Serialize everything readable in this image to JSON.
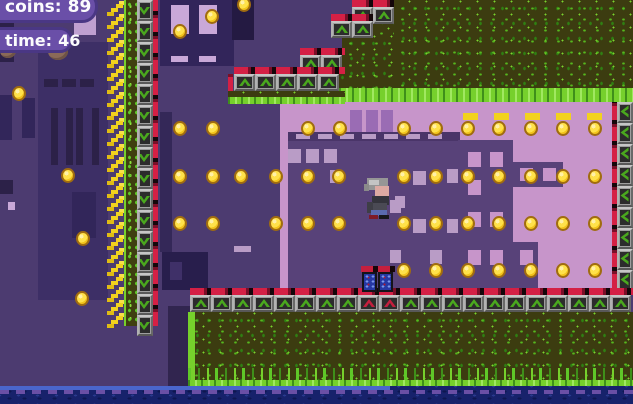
{
  "hud": {
    "coins": {
      "label": "coins:",
      "value": "89"
    },
    "time": {
      "label": "time:",
      "value": "46"
    }
  },
  "palette": {
    "hud_badge": "#6a4fa8",
    "coin_gold": "#f2c41c",
    "brick_red": "#c41f3e",
    "grass_bright": "#76d02c",
    "grass_dark": "#3c3c10",
    "water_navy": "#17226b",
    "bg_purple": "#4c3b70",
    "pink_building": "#c795ca"
  },
  "player": {
    "x": 366,
    "y": 178
  },
  "door": {
    "x": 361,
    "y": 266,
    "type": "blue-door"
  },
  "coins": {
    "singles": [
      [
        19,
        93
      ],
      [
        68,
        175
      ],
      [
        83,
        238
      ],
      [
        82,
        298
      ],
      [
        180,
        31
      ],
      [
        212,
        16
      ],
      [
        244,
        4
      ]
    ],
    "rows": [
      {
        "y": 128,
        "xs": [
          180,
          213,
          308,
          340,
          404,
          436,
          468,
          499,
          531,
          563,
          595
        ]
      },
      {
        "y": 176,
        "xs": [
          180,
          213,
          241,
          276,
          308,
          339,
          404,
          436,
          468,
          499,
          531,
          563,
          595
        ]
      },
      {
        "y": 223,
        "xs": [
          180,
          213,
          276,
          308,
          339,
          404,
          436,
          468,
          499,
          531,
          563,
          595
        ]
      },
      {
        "y": 270,
        "xs": [
          404,
          436,
          468,
          499,
          531,
          563,
          595
        ]
      }
    ]
  }
}
